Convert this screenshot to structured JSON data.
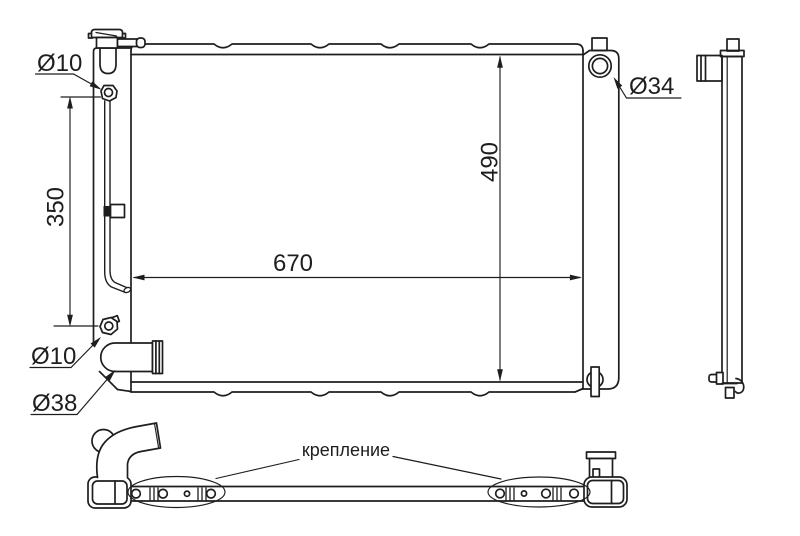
{
  "theme": {
    "background": "#ffffff",
    "ink": "#1e1e1e"
  },
  "labels": {
    "dia_top_fitting": "Ø10",
    "dia_filler_opening": "Ø34",
    "dia_bottom_fitting": "Ø10",
    "dia_outlet_pipe": "Ø38",
    "dim_fitting_span": "350",
    "dim_core_height": "490",
    "dim_core_width": "670",
    "mounting_note": "крепление"
  }
}
